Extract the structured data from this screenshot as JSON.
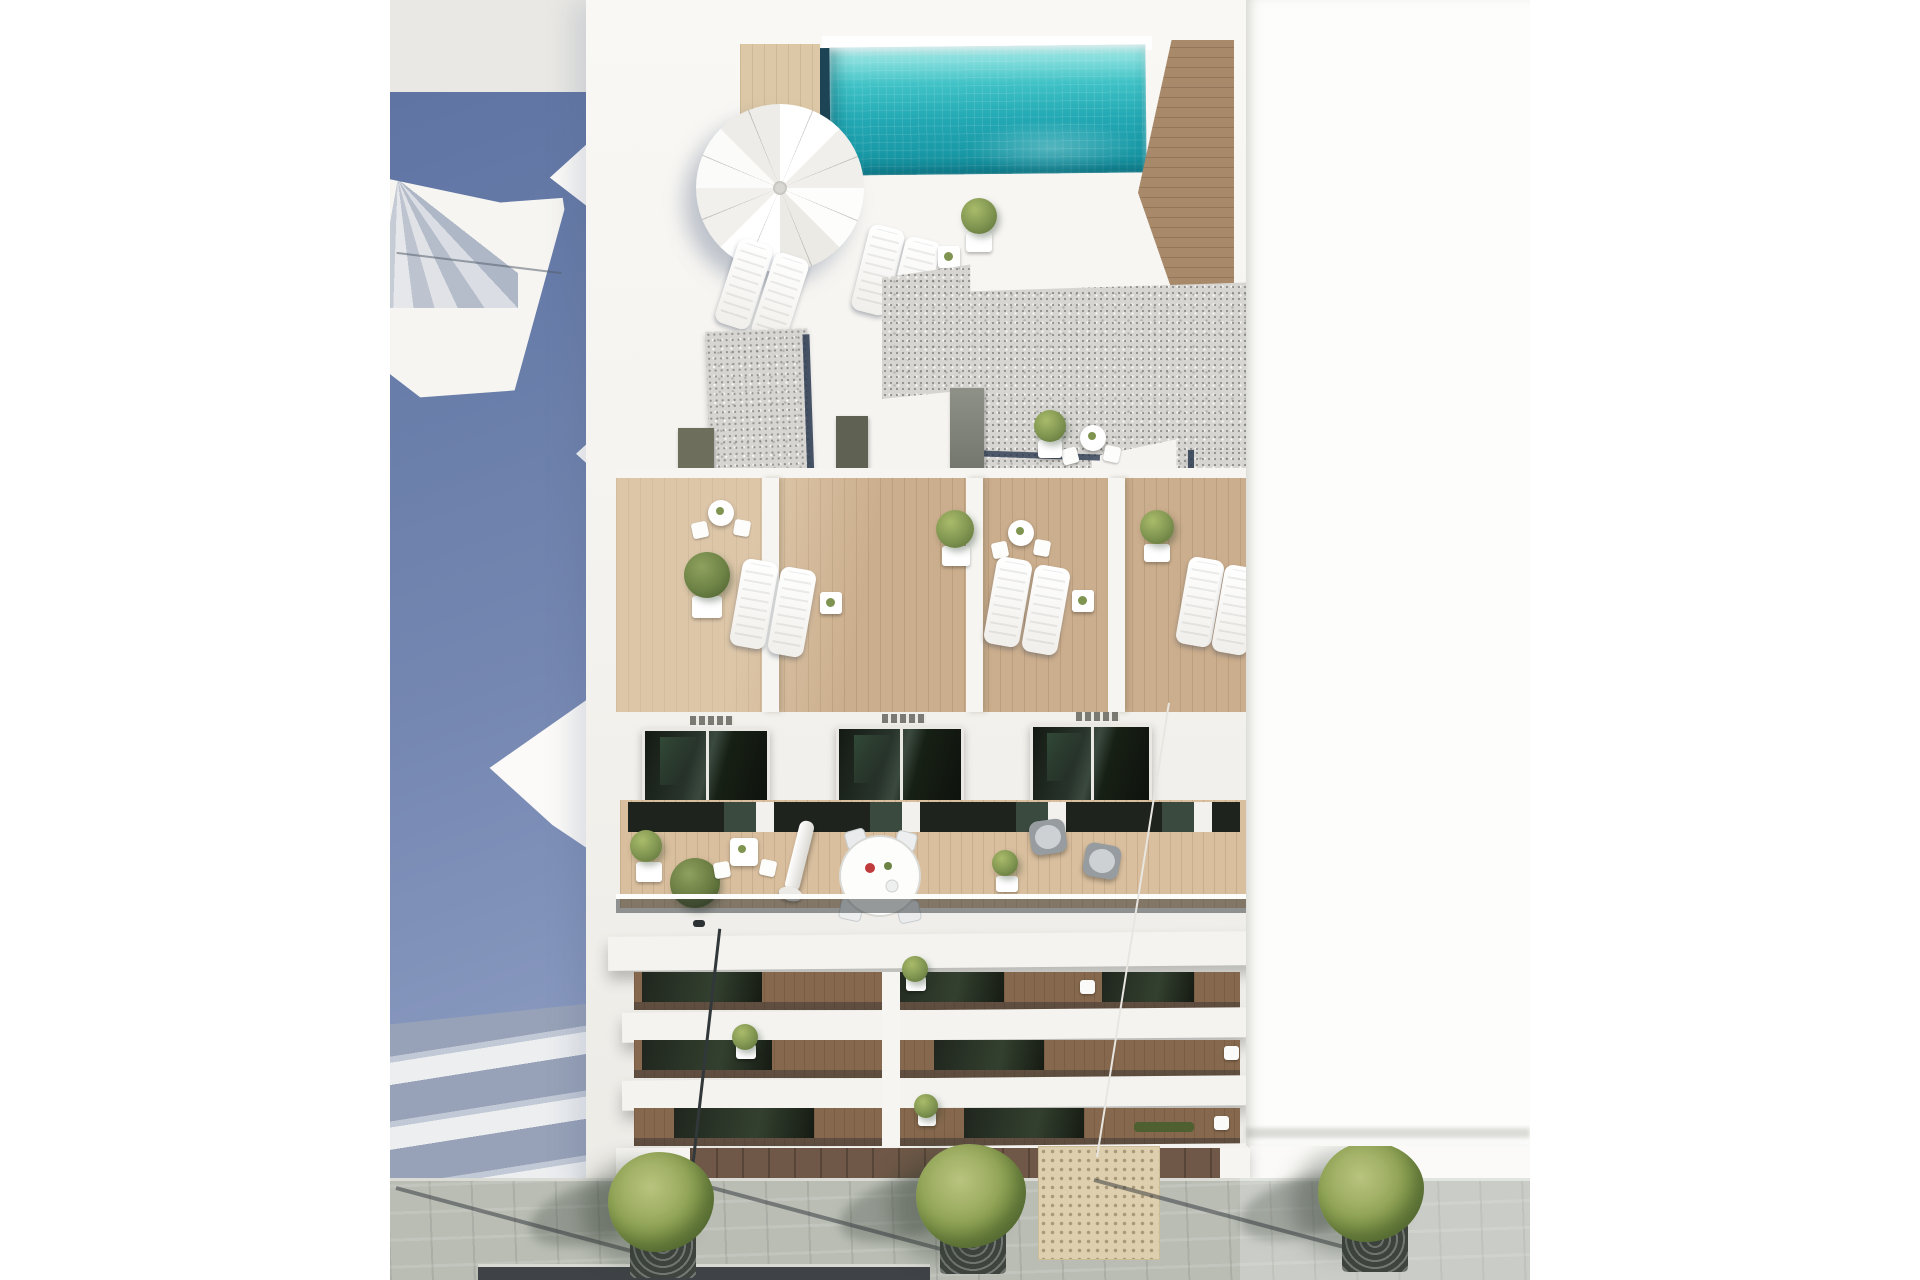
{
  "image": {
    "kind": "architectural 3d render",
    "view": "aerial bird's-eye view",
    "subject": "modern white apartment building with rooftop pool, sun terraces, stacked balconies and street-level sidewalk",
    "lighting": "bright sun from upper right, long blue shadows on the left street"
  },
  "palette": {
    "pageBg": "#ffffff",
    "photoBg": "#fbfaf8",
    "topGray": "#e9e8e4",
    "shadowBlueA": "#5f74a3",
    "shadowBlueB": "#7487b1",
    "shadowBlueC": "#8a9ac0",
    "bandLit": "#eceef0",
    "bandShadow": "#97a2b8",
    "bandMid": "#c2c9d6",
    "wallWhite": "#f6f5f1",
    "wallBright": "#fdfdfb",
    "slab": "#f4f3ef",
    "poolRim": "#c8f1ef",
    "poolA": "#3fc2c6",
    "poolB": "#23a9b4",
    "poolC": "#13909e",
    "poolEdge": "#1c4454",
    "deckLight": "#dcc8a6",
    "walkWood": "#a8896a",
    "terraceWood": "#cbae8d",
    "balconyWood": "#d9bf9e",
    "bandWood": "#85684d",
    "groundWood": "#6f5847",
    "gravelBase": "#d6d5d1",
    "gravelEdge": "#2a3a50",
    "glassA": "#1e241d",
    "railGlass": "rgba(24,30,36,0.45)",
    "leaf": "#7f9450",
    "leafLight": "#a9bb6a",
    "leafDark": "#5d7339",
    "tree": "#8ba050",
    "treeLight": "#b9c47e",
    "treeDark": "#66803c",
    "wicker": "#969c9f",
    "cushion": "#cdd1d3",
    "pave": "#b9bdb4",
    "grate": "#3f443f",
    "road": "#3f4347",
    "tactile": "#decfae"
  },
  "scene": {
    "rooftop": [
      "swimming-pool",
      "pool-coping",
      "wood-deck",
      "wood-walkway",
      "sun-parasol",
      "sun-loungers",
      "side-tables",
      "potted-plants",
      "gravel-roof-planters",
      "roof-access-doors",
      "bistro-set"
    ],
    "terrace_level": [
      "wood-terrace-floor",
      "privacy-dividers",
      "lounger-pairs",
      "bistro-sets",
      "potted-trees"
    ],
    "facade": [
      "ventilation-grilles",
      "dark-glass-sliding-doors"
    ],
    "main_balcony": [
      "round-dining-table",
      "dining-chairs",
      "closed-parasol",
      "wicker-armchairs",
      "boxwood-plants",
      "glass-balustrade"
    ],
    "lower_balconies": [
      "balcony-slabs",
      "glass-doors",
      "planters",
      "balcony-chairs"
    ],
    "street": [
      "paved-sidewalk",
      "street-trees",
      "tree-grates",
      "lamp-post",
      "lamp-shadows",
      "tactile-paving",
      "asphalt-road"
    ],
    "surroundings": [
      "left-neighbour-building-in-shadow",
      "right-neighbour-building-sunlit",
      "cast-parasol-shadow"
    ]
  }
}
